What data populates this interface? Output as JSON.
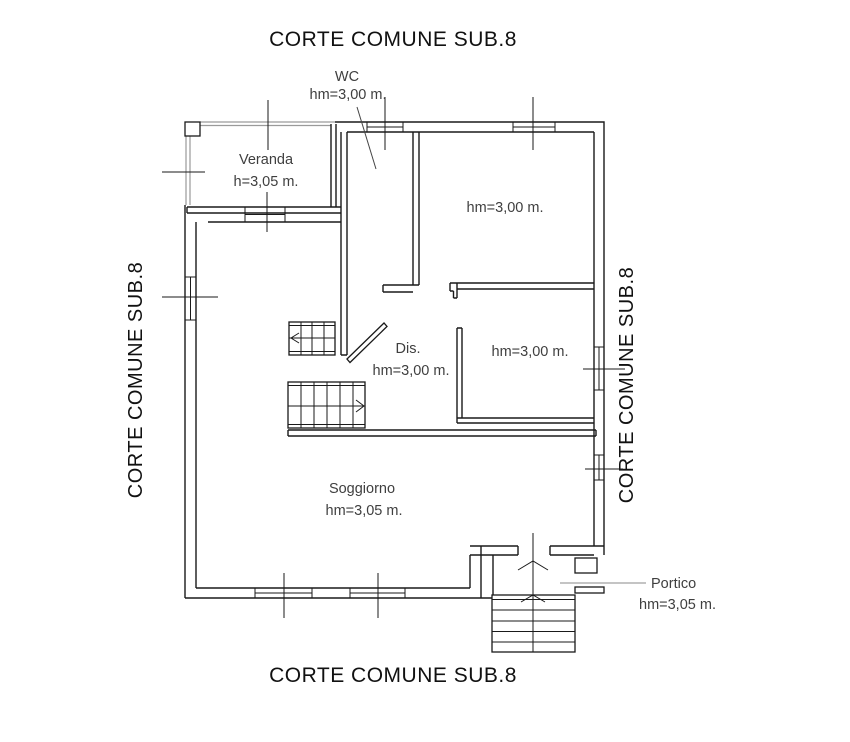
{
  "colors": {
    "wall": "#1a1a1a",
    "glazing_gray": "#9a9a9a",
    "leader_gray": "#8a8a8a",
    "label_text": "#3f3f3f",
    "background": "#ffffff"
  },
  "titles": {
    "top": "CORTE COMUNE SUB.8",
    "bottom": "CORTE COMUNE SUB.8",
    "left": "CORTE COMUNE SUB.8",
    "right": "CORTE COMUNE SUB.8"
  },
  "labels": {
    "wc": {
      "name": "WC",
      "height": "hm=3,00 m."
    },
    "veranda": {
      "name": "Veranda",
      "height": "h=3,05 m."
    },
    "room_top_right": {
      "height": "hm=3,00 m."
    },
    "dis": {
      "name": "Dis.",
      "height": "hm=3,00 m."
    },
    "room_mid_right": {
      "height": "hm=3,00 m."
    },
    "soggiorno": {
      "name": "Soggiorno",
      "height": "hm=3,05 m."
    },
    "portico": {
      "name": "Portico",
      "height": "hm=3,05 m."
    }
  }
}
